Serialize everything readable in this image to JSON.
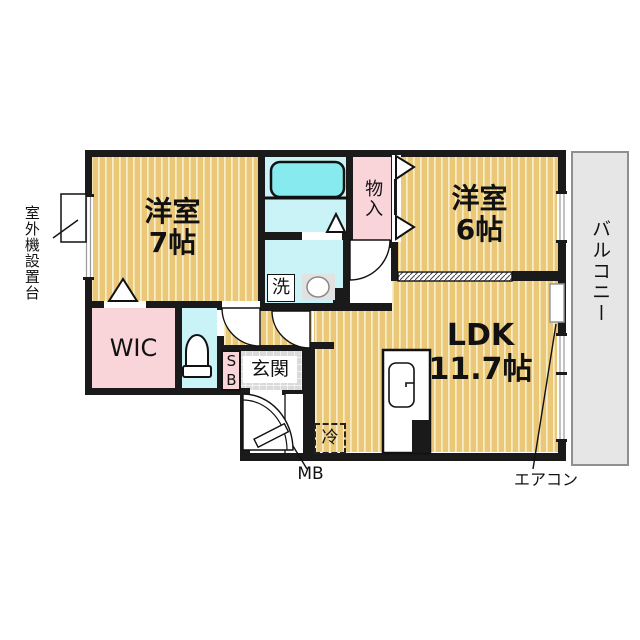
{
  "title": "2LDK apartment floor plan",
  "colors": {
    "wall": "#1a1a1a",
    "floor_tan": "#EBC878",
    "floor_tan_stripe": "#F8EDC9",
    "wet_area_cyan": "#C9F3F6",
    "bathtub_cyan": "#87EAEE",
    "closet_pink": "#F9D4D9",
    "balcony_gray": "#E6E6E6",
    "entry_tile_gray": "#DADADA"
  },
  "rooms": {
    "yoshitsu7": {
      "line1": "洋室",
      "line2": "7帖"
    },
    "yoshitsu6": {
      "line1": "洋室",
      "line2": "6帖"
    },
    "ldk": {
      "line1": "LDK",
      "line2": "11.7帖"
    },
    "wic": {
      "label": "WIC"
    },
    "monoire": {
      "label": "物入"
    },
    "genkan": {
      "label": "玄関"
    },
    "laundry": {
      "label": "洗"
    },
    "fridge": {
      "label": "冷"
    },
    "shoebox": {
      "label": "SB"
    },
    "balcony": {
      "label": "バルコニー"
    }
  },
  "annotations": {
    "outdoor_unit": {
      "label": "室外機設置台"
    },
    "meter_box": {
      "label": "MB"
    },
    "aircon": {
      "label": "エアコン"
    }
  }
}
